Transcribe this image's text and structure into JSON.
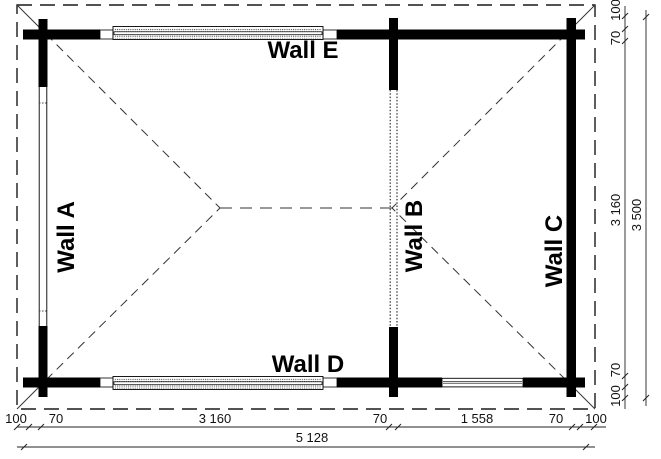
{
  "walls": {
    "a": "Wall A",
    "b": "Wall B",
    "c": "Wall C",
    "d": "Wall D",
    "e": "Wall E"
  },
  "dimensions": {
    "bottom": {
      "segments": [
        "100",
        "70",
        "3 160",
        "70",
        "1 558",
        "70",
        "100"
      ],
      "total": "5 128"
    },
    "right": {
      "segments": [
        "100",
        "70",
        "3 160",
        "70",
        "100"
      ],
      "total": "3 500"
    }
  },
  "colors": {
    "line": "#000000",
    "background": "#ffffff"
  }
}
